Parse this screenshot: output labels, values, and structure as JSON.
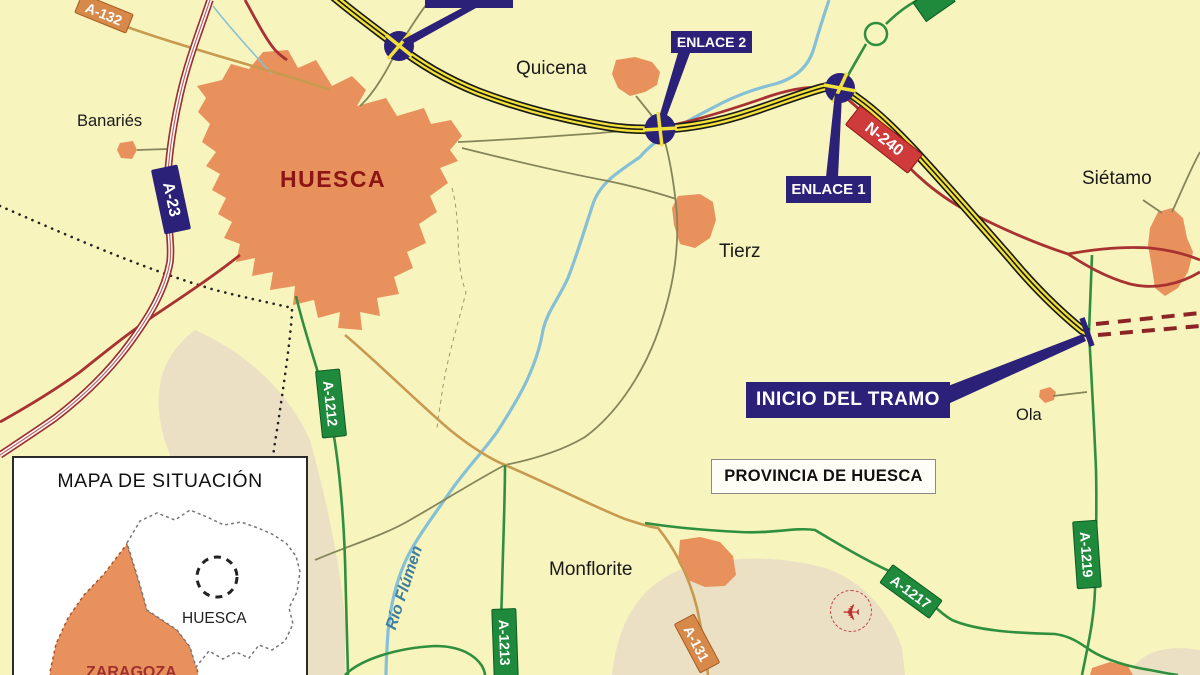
{
  "towns": {
    "huesca": "HUESCA",
    "banaries": "Banariés",
    "quicena": "Quicena",
    "tierz": "Tierz",
    "sietamo": "Siétamo",
    "ola": "Ola",
    "monflorite": "Monflorite"
  },
  "roads": {
    "a23": "A-23",
    "a132": "A-132",
    "n240": "N-240",
    "a1212": "A-1212",
    "a1213": "A-1213",
    "a131": "A-131",
    "a1217": "A-1217",
    "a1219": "A-1219"
  },
  "callouts": {
    "enlace1": "ENLACE 1",
    "enlace2": "ENLACE 2",
    "inicio_del_tramo": "INICIO DEL TRAMO"
  },
  "annotations": {
    "provincia": "PROVINCIA DE HUESCA",
    "river": "Río Flúmen"
  },
  "inset": {
    "title": "MAPA DE SITUACIÓN",
    "province_huesca": "HUESCA",
    "province_zaragoza": "ZARAGOZA"
  },
  "icons": {
    "airplane": "✈"
  },
  "colors": {
    "background": "#f7f4bd",
    "terrain": "#ebe0c4",
    "town_fill": "#e8915c",
    "highway_yellow": "#f2e138",
    "motorway_red": "#9c2f2f",
    "road_red": "#a83232",
    "road_green": "#2f8f3f",
    "road_tan": "#c89a50",
    "road_olive": "#85855a",
    "river_blue": "#86c0d6",
    "callout_navy": "#2b2178",
    "shield_green": "#1f8a3c",
    "shield_orange": "#d7894a",
    "shield_red": "#cf3a3a",
    "city_label_red": "#8b1515"
  }
}
